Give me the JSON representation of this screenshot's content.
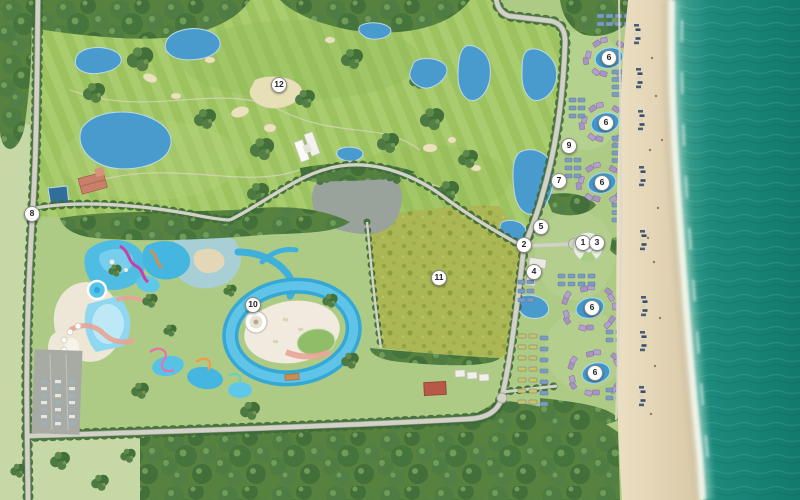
{
  "map": {
    "markers": [
      {
        "label": "1",
        "x": 583,
        "y": 243
      },
      {
        "label": "2",
        "x": 524,
        "y": 245
      },
      {
        "label": "3",
        "x": 597,
        "y": 243
      },
      {
        "label": "4",
        "x": 534,
        "y": 272
      },
      {
        "label": "5",
        "x": 541,
        "y": 227
      },
      {
        "label": "6",
        "x": 609,
        "y": 58
      },
      {
        "label": "6",
        "x": 606,
        "y": 123
      },
      {
        "label": "6",
        "x": 602,
        "y": 183
      },
      {
        "label": "6",
        "x": 592,
        "y": 308
      },
      {
        "label": "6",
        "x": 595,
        "y": 373
      },
      {
        "label": "7",
        "x": 559,
        "y": 181
      },
      {
        "label": "8",
        "x": 32,
        "y": 214
      },
      {
        "label": "9",
        "x": 569,
        "y": 146
      },
      {
        "label": "10",
        "x": 253,
        "y": 305
      },
      {
        "label": "11",
        "x": 439,
        "y": 278
      },
      {
        "label": "12",
        "x": 279,
        "y": 85
      }
    ],
    "palette": {
      "sea": "#1c8a7c",
      "sand": "#e2d4b4",
      "grass": "#aecb86",
      "golf_green": "#9dc361",
      "forest": "#4e7c43",
      "pool_blue": "#4fbce4",
      "road": "#d2d2c9",
      "villa_roof_purple": "#a893c4",
      "villa_roof_blue": "#7b9cc0",
      "villa_roof_yellow": "#cfc45f",
      "marker_bg": "#ffffff",
      "marker_text": "#222222"
    }
  }
}
